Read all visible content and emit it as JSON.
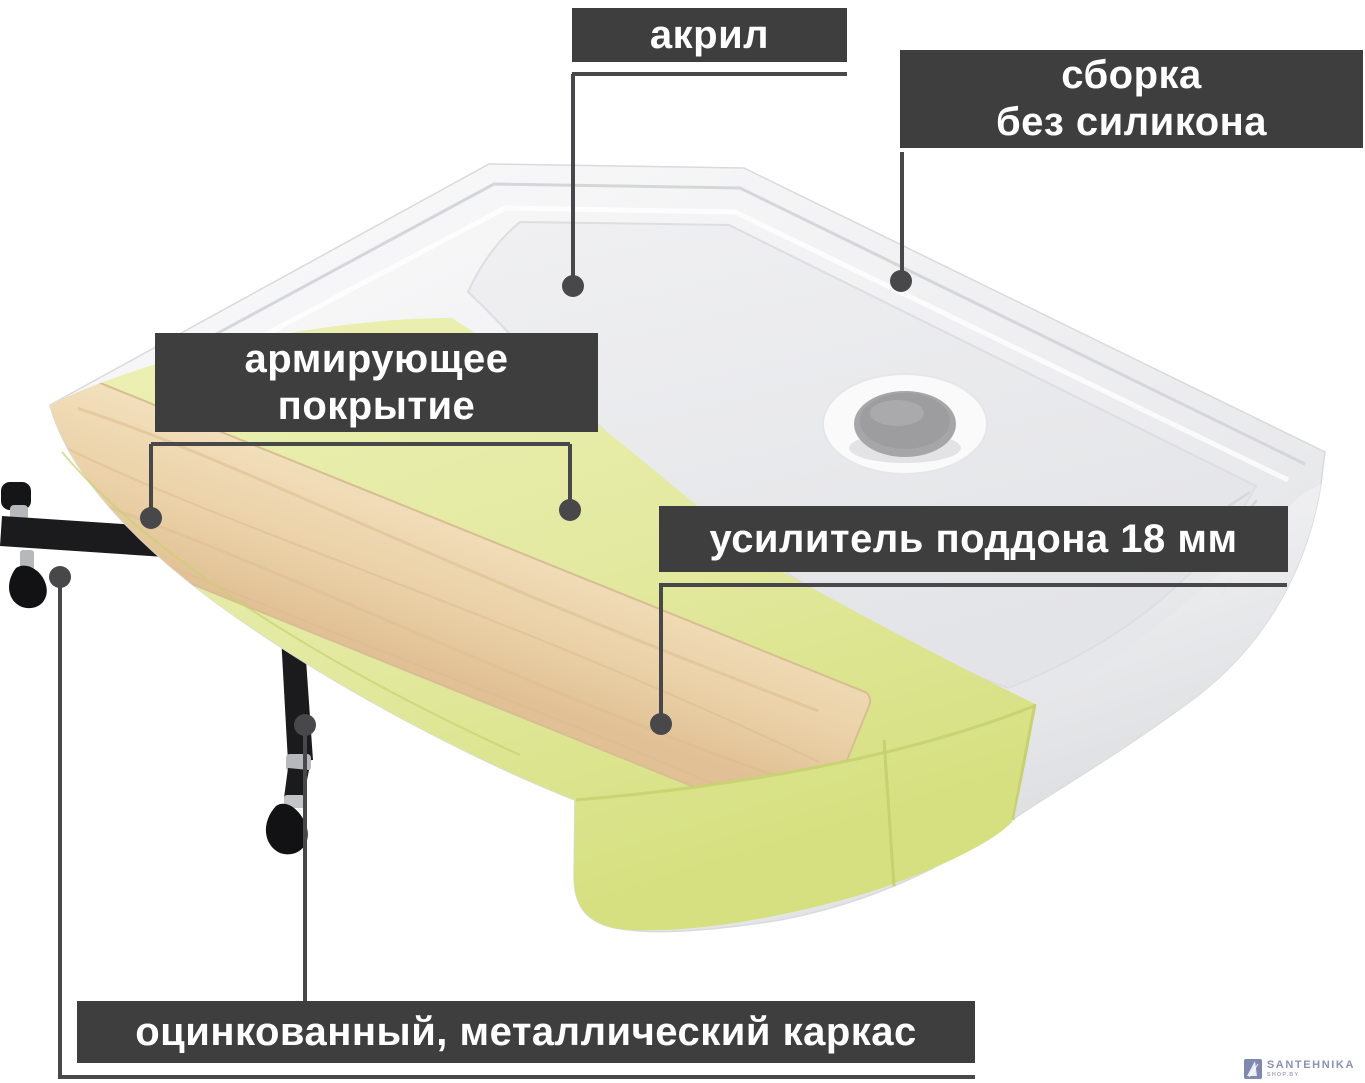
{
  "callouts": {
    "acrylic": {
      "text": "акрил"
    },
    "assembly": {
      "line1": "сборка",
      "line2": "без силикона"
    },
    "coating": {
      "line1": "армирующее",
      "line2": "покрытие"
    },
    "stiffener": {
      "text": "усилитель поддона 18 мм"
    },
    "frame": {
      "text": "оцинкованный, металлический каркас"
    }
  },
  "watermark": {
    "brand": "SANTEHNIKA",
    "sub": "SHOP.BY"
  },
  "colors": {
    "label_bg": "#3e3e3e",
    "label_text": "#ffffff",
    "leader": "#48484a",
    "yellow": "#e3e9a0",
    "yellow_edge": "#c7d171",
    "wood": "#ecd2ab",
    "wood_vein": "#dcba8c",
    "drain": "#9d9d9f",
    "watermark": "#8a92b4",
    "watermark_sub": "#a2a8c2"
  }
}
